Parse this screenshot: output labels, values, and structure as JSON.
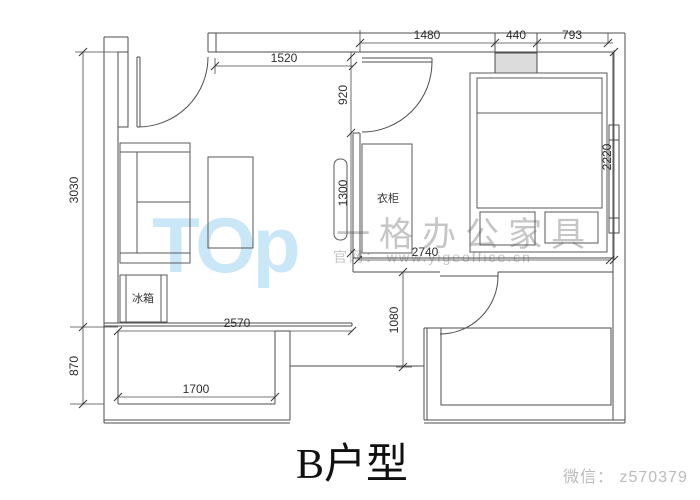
{
  "title": "B户型",
  "watermark": {
    "logo_text": "TOp",
    "brand": "一格办公家具",
    "website": "官网： www.yigeoffice.cn",
    "wechat": "微信： z570379"
  },
  "labels": {
    "wardrobe": "衣柜",
    "fridge": "冰箱"
  },
  "dims": {
    "d1480": "1480",
    "d440": "440",
    "d793": "793",
    "d1520": "1520",
    "d920": "920",
    "d1300": "1300",
    "d3030": "3030",
    "d870": "870",
    "d2220": "2220",
    "d2740": "2740",
    "d1080": "1080",
    "d2570": "2570",
    "d1700": "1700"
  },
  "colors": {
    "wall_line": "#4d4d4d",
    "dim_text": "#2e2e2e",
    "window_fill": "#dcdcdc",
    "watermark_blue": "#c9e7f7",
    "watermark_gray": "#c6c6c6",
    "watermark_wechat": "#bbbbbb",
    "title_color": "#101010"
  }
}
